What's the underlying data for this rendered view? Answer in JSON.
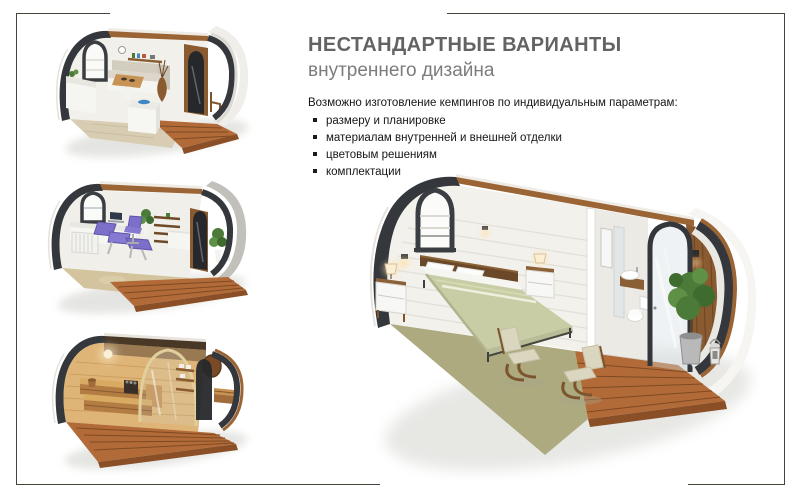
{
  "slide": {
    "heading": {
      "title": "НЕСТАНДАРТНЫЕ ВАРИАНТЫ",
      "subtitle": "внутреннего дизайна"
    },
    "body": {
      "intro": "Возможно изготовление кемпингов по индивидуальным параметрам:",
      "bullets": [
        "размеру и планировке",
        "материалам внутренней и внешней отделки",
        "цветовым решениям",
        "комплектации"
      ],
      "bullet_style": "square"
    },
    "images": {
      "top_left": "dining-pod-render",
      "middle_left": "massage-room-pod-render",
      "bottom_left": "sauna-pod-render",
      "main": "bedroom-pod-render"
    },
    "colors": {
      "title_gray": "#636363",
      "subtitle_gray": "#7c7c7c",
      "body_text": "#161616",
      "frame_border": "#45453c",
      "pod_shell": "#34373b",
      "roof_wood": "#9a6434",
      "deck_wood": "#b26b38",
      "wall_white": "#f2f0eb",
      "carpet_green": "#acaa7e",
      "bedspread_sage": "#c9cda6",
      "massage_purple": "#7b6fc9",
      "sauna_wood": "#dfb577"
    }
  }
}
